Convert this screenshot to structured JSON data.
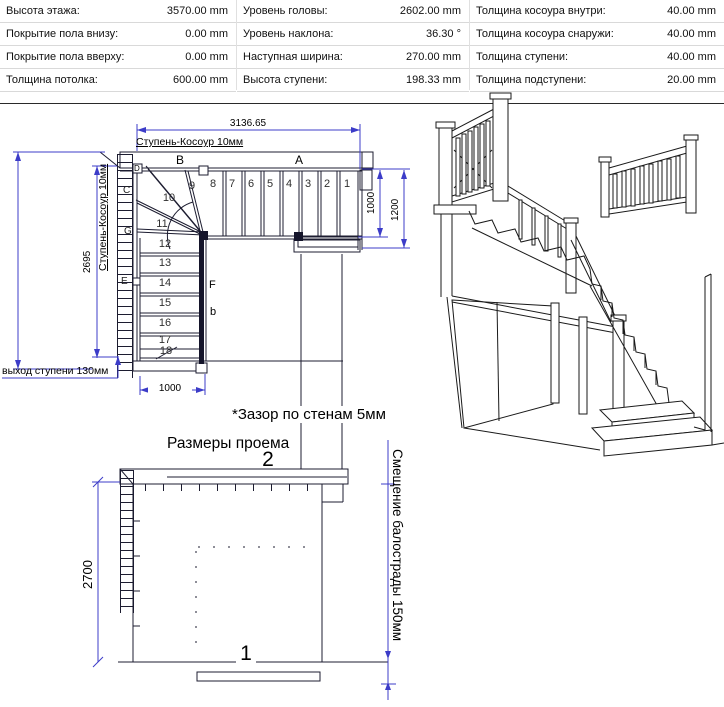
{
  "table": {
    "col1": [
      {
        "label": "Высота этажа:",
        "value": "3570.00 mm"
      },
      {
        "label": "Покрытие пола внизу:",
        "value": "0.00 mm"
      },
      {
        "label": "Покрытие пола вверху:",
        "value": "0.00 mm"
      },
      {
        "label": "Толщина потолка:",
        "value": "600.00 mm"
      }
    ],
    "col2": [
      {
        "label": "Уровень головы:",
        "value": "2602.00 mm"
      },
      {
        "label": "Уровень наклона:",
        "value": "36.30 °"
      },
      {
        "label": "Наступная ширина:",
        "value": "270.00 mm"
      },
      {
        "label": "Высота ступени:",
        "value": "198.33 mm"
      }
    ],
    "col3": [
      {
        "label": "Толщина косоура внутри:",
        "value": "40.00 mm"
      },
      {
        "label": "Толщина косоура снаружи:",
        "value": "40.00 mm"
      },
      {
        "label": "Толщина ступени:",
        "value": "40.00 mm"
      },
      {
        "label": "Толщина подступени:",
        "value": "20.00 mm"
      }
    ]
  },
  "plan": {
    "dim_width_top": "3136.65",
    "stringer_label_top": "Ступень-Косоур 10мм",
    "stringer_label_left": "Ступень-Косоур 10мм",
    "dim_height_left": "2695",
    "dim_flight_width": "1000",
    "dim_right_inner": "1000",
    "dim_right_outer": "1200",
    "step_exit_label": "выход ступени 130мм",
    "beam_left": "В",
    "beam_right": "А",
    "steps_top": [
      "8",
      "7",
      "6",
      "5",
      "4",
      "3",
      "2",
      "1"
    ],
    "steps_winder": [
      "9",
      "10",
      "11"
    ],
    "steps_down": [
      "12",
      "13",
      "14",
      "15",
      "16",
      "17",
      "18"
    ],
    "marker_c": "С",
    "marker_d": "D",
    "marker_e": "Е",
    "marker_g": "G",
    "marker_f": "F",
    "marker_b": "b"
  },
  "notes": {
    "wall_gap": "*Зазор по стенам 5мм"
  },
  "opening": {
    "title": "Размеры проема",
    "dim_height": "2700",
    "label_top_edge": "2",
    "label_bottom_edge": "1",
    "balustrade_offset_label": "Смещение балострады 150мм"
  },
  "colors": {
    "draw_line": "#1c1c30",
    "dim_line": "#3c3cc8",
    "text": "#000000"
  }
}
